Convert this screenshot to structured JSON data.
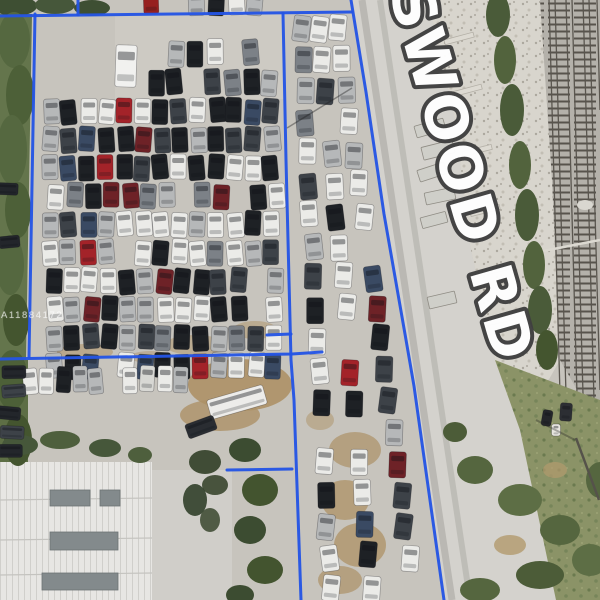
{
  "image": {
    "description": "Aerial drone photo of fenced auto salvage yard lots outlined in blue, beside Ravenswood Rd and railroad tracks",
    "road_label": "SWOOD RD",
    "watermark": "A11884172",
    "boundary_color": "#2454e4",
    "road_label_fill": "#ffffff",
    "road_label_outline": "#404040"
  },
  "scene": {
    "boundary_segments": [
      [
        [
          0,
          16
        ],
        [
          352,
          12
        ]
      ],
      [
        [
          78,
          0
        ],
        [
          78,
          15
        ]
      ],
      [
        [
          35,
          14
        ],
        [
          29,
          357
        ]
      ],
      [
        [
          0,
          359
        ],
        [
          292,
          354
        ],
        [
          322,
          352
        ]
      ],
      [
        [
          267,
          335
        ],
        [
          291,
          334
        ]
      ],
      [
        [
          227,
          470
        ],
        [
          292,
          469
        ]
      ],
      [
        [
          283,
          13
        ],
        [
          286,
          160
        ],
        [
          291,
          360
        ],
        [
          294,
          400
        ],
        [
          301,
          600
        ]
      ],
      [
        [
          351,
          0
        ],
        [
          366,
          92
        ],
        [
          384,
          214
        ],
        [
          405,
          334
        ],
        [
          414,
          386
        ],
        [
          444,
          600
        ]
      ]
    ],
    "palettes": {
      "mixed": [
        [
          "#ebebe8",
          0.3
        ],
        [
          "#1e2125",
          0.22
        ],
        [
          "#3d4248",
          0.14
        ],
        [
          "#b6b8b9",
          0.13
        ],
        [
          "#7c8187",
          0.07
        ],
        [
          "#6e2227",
          0.07
        ],
        [
          "#a32329",
          0.04
        ],
        [
          "#3a4a63",
          0.03
        ]
      ],
      "light": [
        [
          "#ebebe8",
          0.45
        ],
        [
          "#d8d8d4",
          0.2
        ],
        [
          "#b6b8b9",
          0.15
        ],
        [
          "#1e2125",
          0.12
        ],
        [
          "#6e2227",
          0.08
        ]
      ],
      "dark": [
        [
          "#23262b",
          0.5
        ],
        [
          "#3d4248",
          0.3
        ],
        [
          "#565b61",
          0.2
        ]
      ]
    },
    "grids": [
      {
        "x0": 45,
        "cols": 13,
        "cellw": 18.4,
        "y0": 97,
        "rows": 10,
        "pitch": 28.3,
        "w": 16,
        "h": 25,
        "skip": 0.06,
        "pal": "mixed"
      },
      {
        "x0": 148,
        "cols": 7,
        "cellw": 19,
        "y0": 38,
        "rows": 2,
        "pitch": 30,
        "w": 16,
        "h": 26,
        "skip": 0.3,
        "pal": "mixed"
      },
      {
        "x0": 190,
        "cols": 5,
        "cellw": 19,
        "y0": -12,
        "rows": 1,
        "pitch": 30,
        "w": 16,
        "h": 24,
        "skip": 0.25,
        "pal": "mixed"
      },
      {
        "x0": 3,
        "cols": 11,
        "cellw": 16.8,
        "y0": 365,
        "rows": 1,
        "pitch": 30,
        "w": 14.5,
        "h": 26,
        "skip": 0.05,
        "pal": "light"
      },
      {
        "x0": 2,
        "cols": 1,
        "cellw": 20,
        "y0": 362,
        "rows": 5,
        "pitch": 20,
        "w": 24,
        "h": 13,
        "skip": 0.15,
        "pal": "dark"
      },
      {
        "x0": 0,
        "cols": 1,
        "cellw": 20,
        "y0": 175,
        "rows": 7,
        "pitch": 27,
        "w": 21,
        "h": 12,
        "skip": 0.35,
        "pal": "dark"
      }
    ],
    "strip": {
      "y0": 14,
      "rows": 19,
      "pitch": 31,
      "slots": [
        0.16,
        0.5,
        0.84
      ],
      "w": 17,
      "h": 26,
      "skip": 0.2,
      "pal": "mixed",
      "ax": [
        283,
        13,
        301,
        600
      ],
      "bx": [
        351,
        0,
        444,
        600
      ],
      "margin": 9
    },
    "vehicles": [
      {
        "x": 126,
        "y": 66,
        "w": 21,
        "h": 42,
        "rot": 2,
        "fill": "#f1f1ef"
      },
      {
        "x": 151,
        "y": 2,
        "w": 15,
        "h": 24,
        "rot": -2,
        "fill": "#96201f"
      },
      {
        "x": 237,
        "y": 402,
        "w": 58,
        "h": 20,
        "rot": -16,
        "fill": "#edecea"
      },
      {
        "x": 201,
        "y": 427,
        "w": 30,
        "h": 15,
        "rot": -20,
        "fill": "#2a2d32"
      },
      {
        "x": 547,
        "y": 418,
        "w": 10,
        "h": 16,
        "rot": 10,
        "fill": "#24262a"
      },
      {
        "x": 566,
        "y": 412,
        "w": 12,
        "h": 18,
        "rot": 4,
        "fill": "#2c2e33"
      },
      {
        "x": 556,
        "y": 430,
        "w": 9,
        "h": 12,
        "rot": 0,
        "fill": "#e8e6e0"
      }
    ],
    "debris": [
      {
        "x": 430,
        "y": 128,
        "w": 30,
        "h": 12,
        "rot": -16
      },
      {
        "x": 438,
        "y": 150,
        "w": 32,
        "h": 13,
        "rot": -14
      },
      {
        "x": 432,
        "y": 172,
        "w": 28,
        "h": 12,
        "rot": -18
      },
      {
        "x": 440,
        "y": 196,
        "w": 30,
        "h": 12,
        "rot": -12
      },
      {
        "x": 434,
        "y": 220,
        "w": 26,
        "h": 11,
        "rot": -15
      },
      {
        "x": 442,
        "y": 300,
        "w": 28,
        "h": 12,
        "rot": -13
      }
    ],
    "blobs": [
      [
        15,
        6,
        22,
        10,
        "#3e4f33",
        1
      ],
      [
        55,
        5,
        20,
        9,
        "#46573a",
        1
      ],
      [
        92,
        8,
        18,
        8,
        "#3e4f33",
        1
      ],
      [
        14,
        40,
        16,
        28,
        "#556840",
        1
      ],
      [
        20,
        95,
        14,
        30,
        "#4d6038",
        1
      ],
      [
        12,
        150,
        15,
        35,
        "#556840",
        1
      ],
      [
        18,
        210,
        13,
        28,
        "#4d6038",
        1
      ],
      [
        10,
        265,
        14,
        30,
        "#556840",
        1
      ],
      [
        16,
        320,
        13,
        26,
        "#44552f",
        1
      ],
      [
        12,
        380,
        16,
        30,
        "#4d6038",
        1
      ],
      [
        18,
        440,
        14,
        26,
        "#44552f",
        1
      ],
      [
        498,
        15,
        12,
        22,
        "#4a5b39",
        1
      ],
      [
        505,
        60,
        11,
        24,
        "#52633d",
        1
      ],
      [
        512,
        110,
        12,
        26,
        "#4a5b39",
        1
      ],
      [
        520,
        165,
        11,
        24,
        "#52633d",
        1
      ],
      [
        527,
        215,
        12,
        26,
        "#4a5b39",
        1
      ],
      [
        534,
        265,
        11,
        24,
        "#52633d",
        1
      ],
      [
        540,
        310,
        12,
        24,
        "#4a5b39",
        1
      ],
      [
        547,
        350,
        11,
        20,
        "#44552f",
        1
      ],
      [
        475,
        470,
        18,
        14,
        "#55663f",
        1
      ],
      [
        520,
        500,
        22,
        16,
        "#5d6e45",
        1
      ],
      [
        560,
        530,
        20,
        15,
        "#55663f",
        1
      ],
      [
        590,
        560,
        18,
        16,
        "#5d6e45",
        1
      ],
      [
        540,
        575,
        24,
        14,
        "#4c5c38",
        1
      ],
      [
        480,
        590,
        20,
        12,
        "#55663f",
        1
      ],
      [
        600,
        480,
        14,
        18,
        "#55663f",
        1
      ],
      [
        455,
        432,
        12,
        10,
        "#4c5c38",
        1
      ],
      [
        510,
        545,
        16,
        10,
        "#b29a6d",
        0.8
      ],
      [
        555,
        470,
        12,
        8,
        "#b29a6d",
        0.7
      ],
      [
        245,
        450,
        16,
        12,
        "#3c4c31",
        1
      ],
      [
        260,
        490,
        18,
        16,
        "#43542f",
        1
      ],
      [
        250,
        530,
        16,
        14,
        "#3c4c31",
        1
      ],
      [
        265,
        570,
        18,
        14,
        "#43542f",
        1
      ],
      [
        240,
        595,
        14,
        10,
        "#3c4c31",
        1
      ],
      [
        205,
        462,
        16,
        12,
        "#39462e",
        0.95
      ],
      [
        215,
        485,
        13,
        10,
        "#39462e",
        0.9
      ],
      [
        195,
        500,
        12,
        16,
        "#31402a",
        0.9
      ],
      [
        210,
        520,
        10,
        12,
        "#39462e",
        0.85
      ],
      [
        20,
        445,
        18,
        10,
        "#46573a",
        1
      ],
      [
        60,
        440,
        20,
        9,
        "#4e5f3d",
        1
      ],
      [
        105,
        448,
        16,
        9,
        "#46573a",
        1
      ],
      [
        140,
        455,
        12,
        8,
        "#4e5f3d",
        1
      ]
    ],
    "dirt": [
      [
        85,
        352,
        28,
        8,
        0.55
      ],
      [
        195,
        345,
        30,
        10,
        0.5
      ],
      [
        255,
        330,
        22,
        9,
        0.5
      ],
      [
        150,
        357,
        20,
        6,
        0.45
      ],
      [
        240,
        385,
        52,
        26,
        0.9
      ],
      [
        220,
        415,
        40,
        16,
        0.8
      ],
      [
        355,
        450,
        26,
        18,
        0.7
      ],
      [
        345,
        500,
        24,
        20,
        0.75
      ],
      [
        360,
        545,
        26,
        22,
        0.75
      ],
      [
        340,
        580,
        22,
        14,
        0.7
      ],
      [
        320,
        420,
        14,
        10,
        0.5
      ]
    ]
  }
}
